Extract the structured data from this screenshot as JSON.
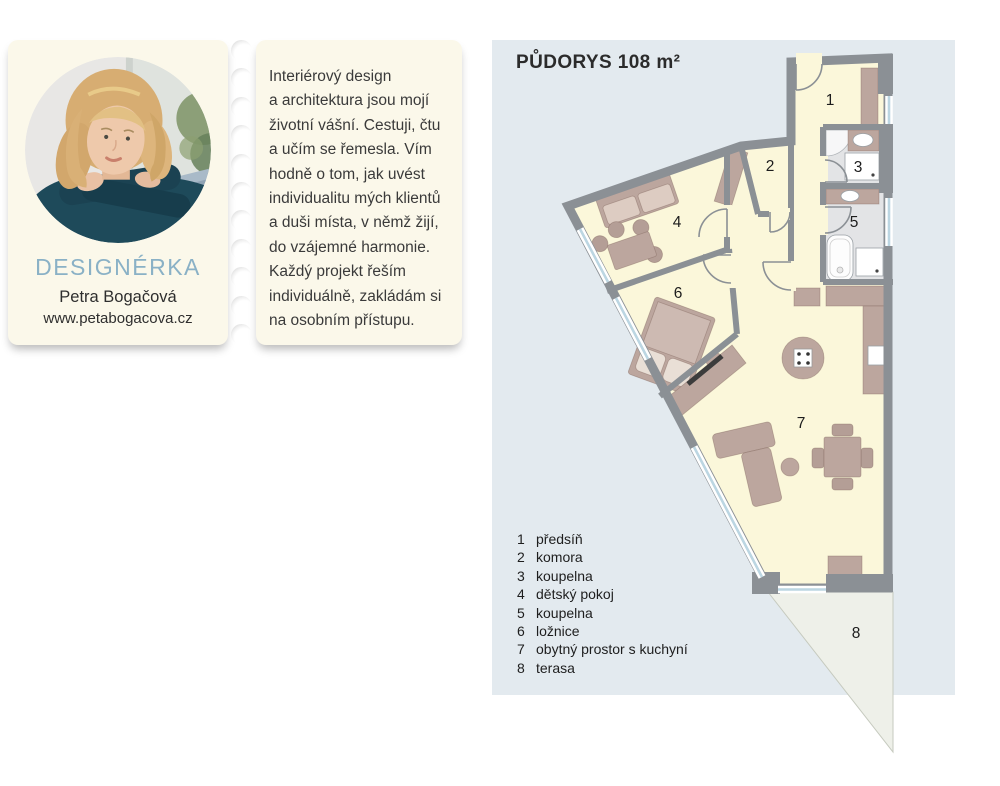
{
  "profile_card": {
    "role_title": "DESIGNÉRKA",
    "name": "Petra Bogačová",
    "website": "www.petabogacova.cz",
    "bio_lines": [
      "Interiérový design",
      "a architektura jsou mojí",
      "životní vášní. Cestuji, čtu",
      "a učím se řemesla. Vím",
      "hodně o tom, jak uvést",
      "individualitu mých klientů",
      "a duši místa, v němž žijí,",
      "do vzájemné harmonie.",
      "Každý projekt řeším",
      "individuálně, zakládám si",
      "na osobním přístupu."
    ]
  },
  "floor_plan": {
    "title": "PŮDORYS 108 m²",
    "legend": [
      {
        "num": "1",
        "label": "předsíň"
      },
      {
        "num": "2",
        "label": "komora"
      },
      {
        "num": "3",
        "label": "koupelna"
      },
      {
        "num": "4",
        "label": "dětský pokoj"
      },
      {
        "num": "5",
        "label": "koupelna"
      },
      {
        "num": "6",
        "label": "ložnice"
      },
      {
        "num": "7",
        "label": "obytný prostor s kuchyní"
      },
      {
        "num": "8",
        "label": "terasa"
      }
    ]
  },
  "colors": {
    "accent_blue": "#8ab1c6",
    "panel_bg": "#e3eaef",
    "card_bg": "#fbf8ea",
    "room_fill": "#fbf7da",
    "wall": "#8b9095",
    "furniture": "#bca69e",
    "bath_floor": "#e3e4e6",
    "terrace": "#eef0e9",
    "window": "#bcd6e2"
  }
}
